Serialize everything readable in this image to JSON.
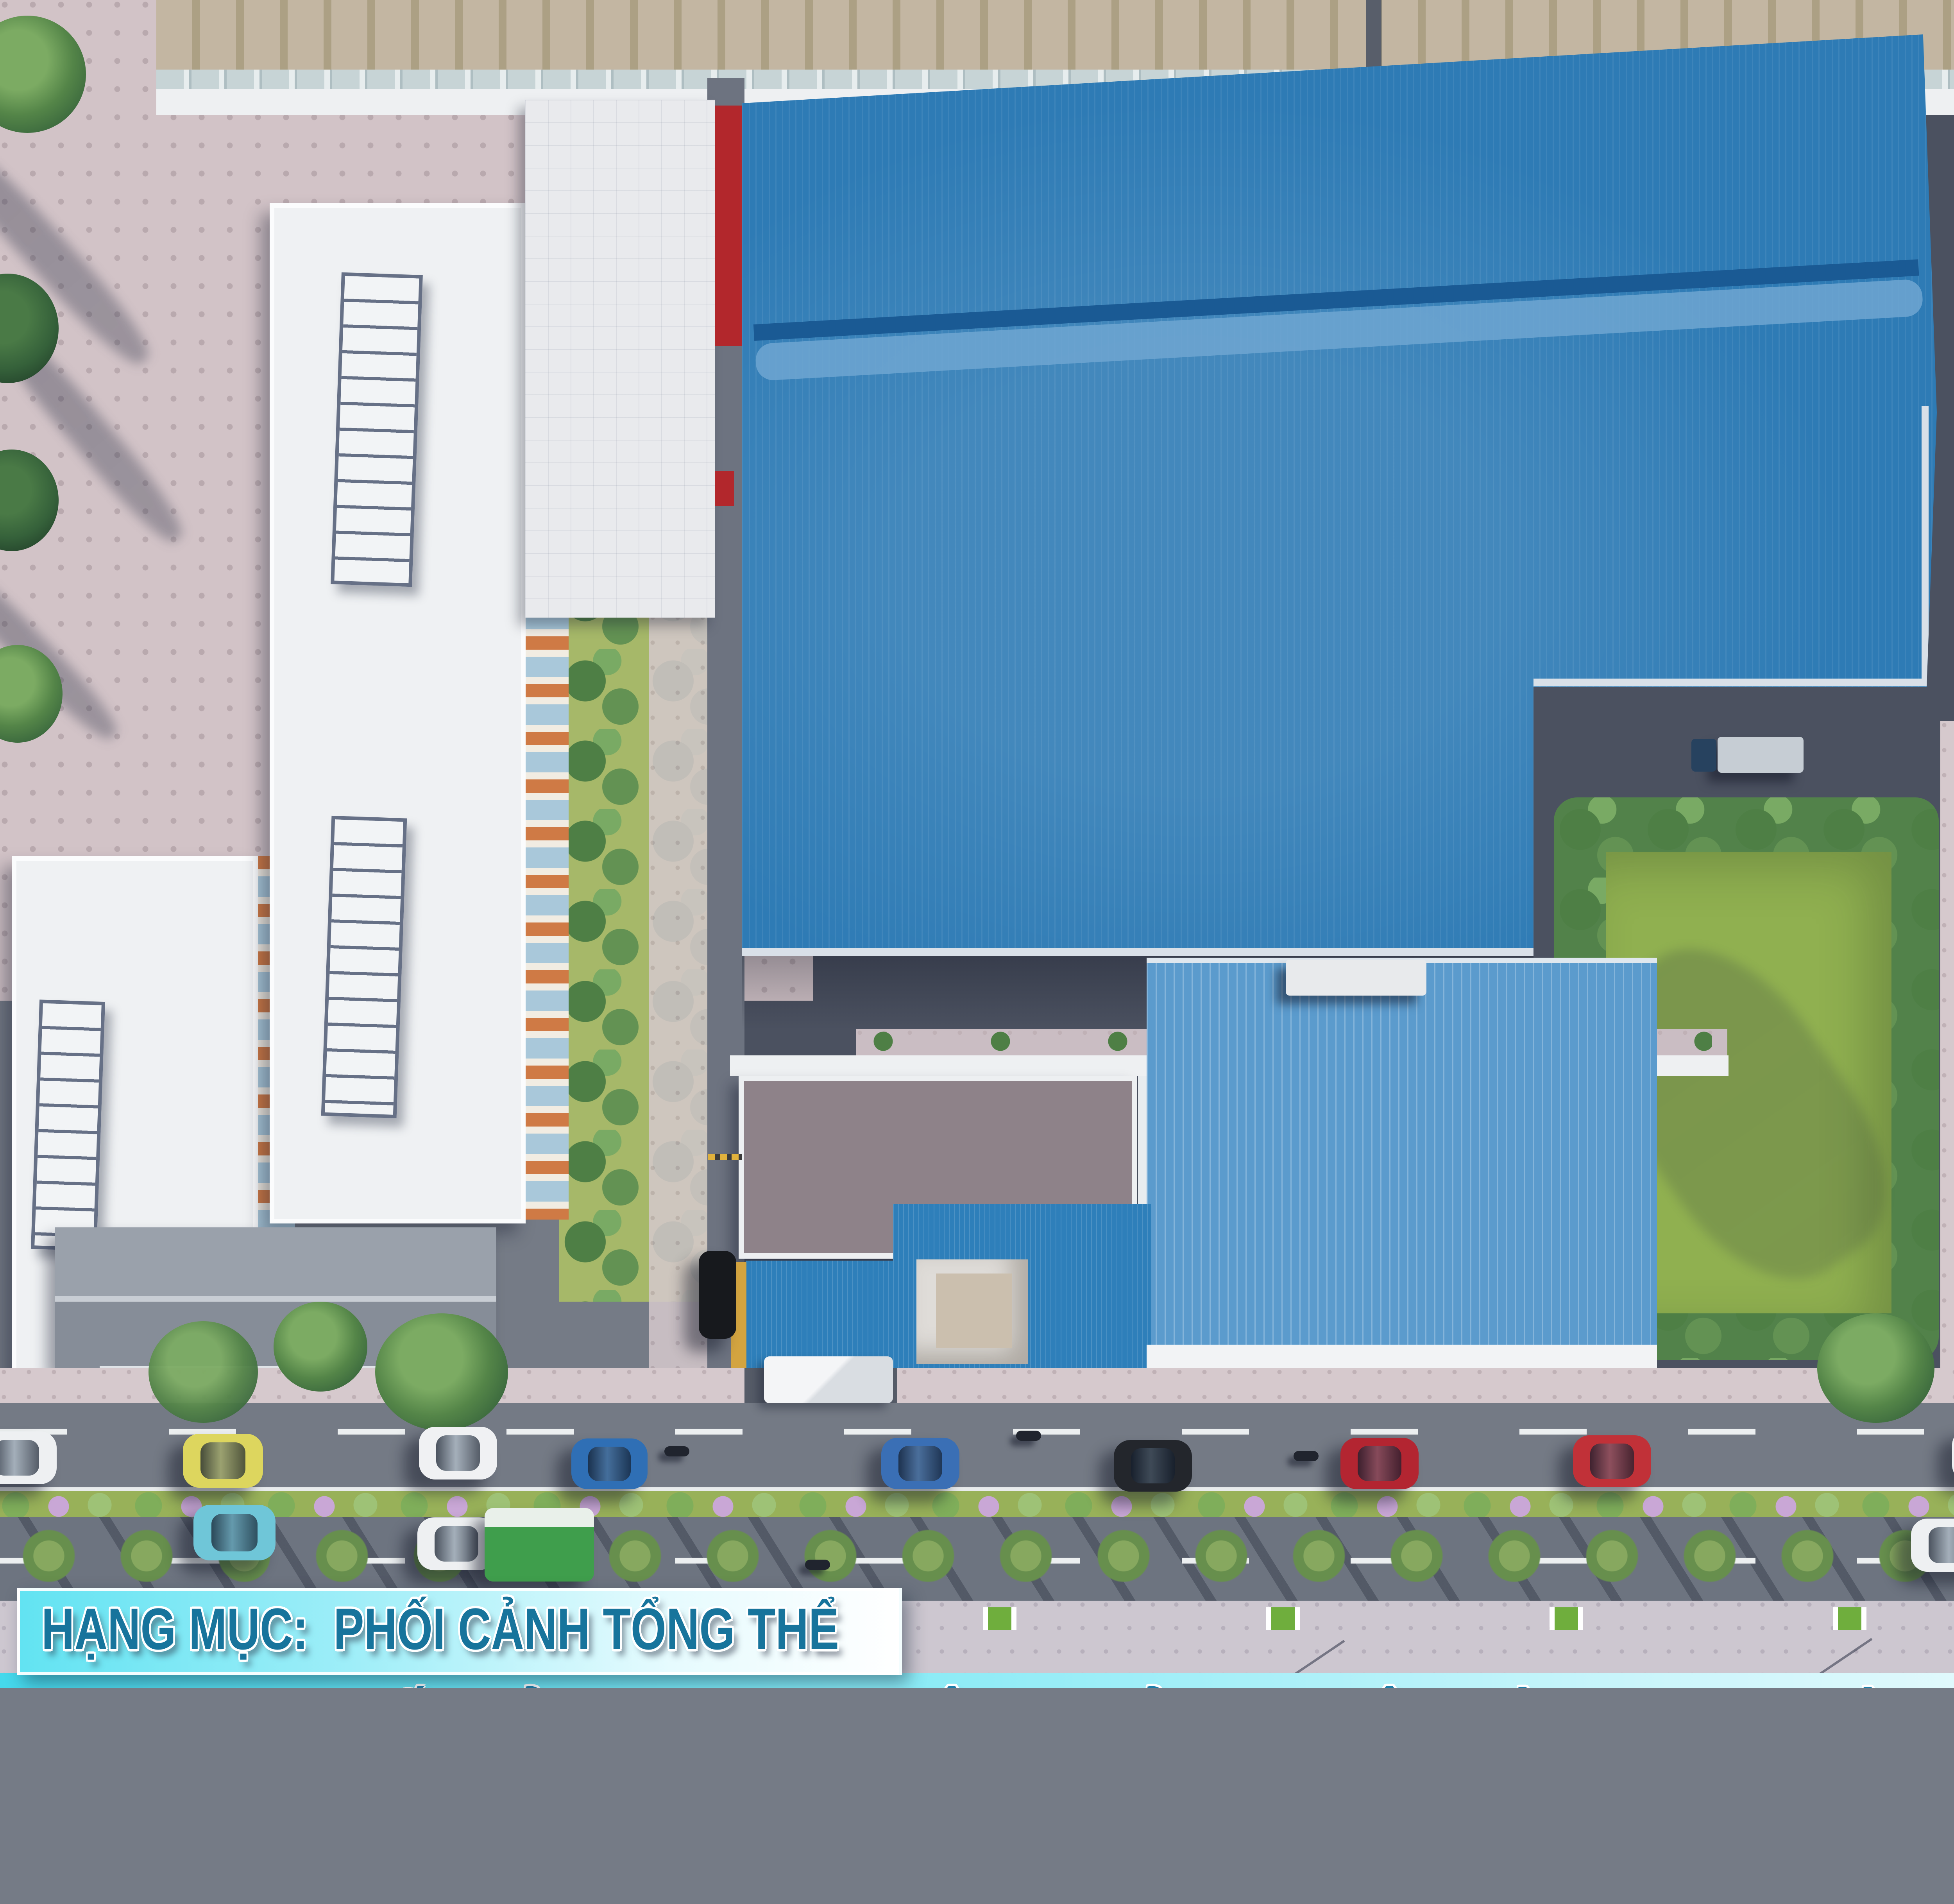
{
  "title_block": {
    "item_prefix": "HẠNG MỤC:",
    "item_value": "PHỐI CẢNH TỔNG THỂ",
    "main_title": "PHỐI CẢNH TRUNG TÂM KHỞI NGHIỆP VÀ TRƯNG BÀY SẢN PHẨM KCN",
    "investor_label": "CHỦ ĐẦU TƯ:",
    "investor_value": "C.TY KNDT",
    "consultant_label": "TƯ VẤN THIẾT KẾ:",
    "consultant_value": "C.TY TNHH TV TK XD KIẾN NGỌC VIỆT",
    "site_location": "Địa điểm xây dựng: CC074228 KCN TRẦN QUỐC TOẢN, CAO LÃNH, ĐỒNG THÁP",
    "headquarters": "Trụ sở: khu Nam Thông 3, quận 7, thành phố HỒ CHÍ MINH"
  },
  "scene": {
    "type": "aerial-architectural-rendering",
    "elements": [
      "main-factory-blue-roof",
      "exhibition-hall-roof",
      "office-flat-roof",
      "entrance-blue-roof",
      "tensile-canopy",
      "lawn-courtyard",
      "tree-buffer-strip",
      "boulevard-with-median",
      "palm-tree-row",
      "right-warehouse",
      "tall-showroom-building",
      "apartment-blocks",
      "paved-plaza",
      "parked-cars",
      "green-bus",
      "delivery-trucks",
      "motorbikes"
    ]
  },
  "palette": {
    "main_roof": "#2e7bb5",
    "exhibition_roof": "#5b9bcd",
    "secondary_roof": "#2e7fba",
    "accent_red": "#b3272c",
    "accent_yellow": "#d3a440",
    "lawn": "#90b050",
    "site_asphalt": "#4b5160",
    "road_asphalt": "#747a85",
    "sidewalk_pink": "#d6c9cd",
    "banner_cyan": "#5ce0f0",
    "text_teal": "#1b7ea9"
  }
}
